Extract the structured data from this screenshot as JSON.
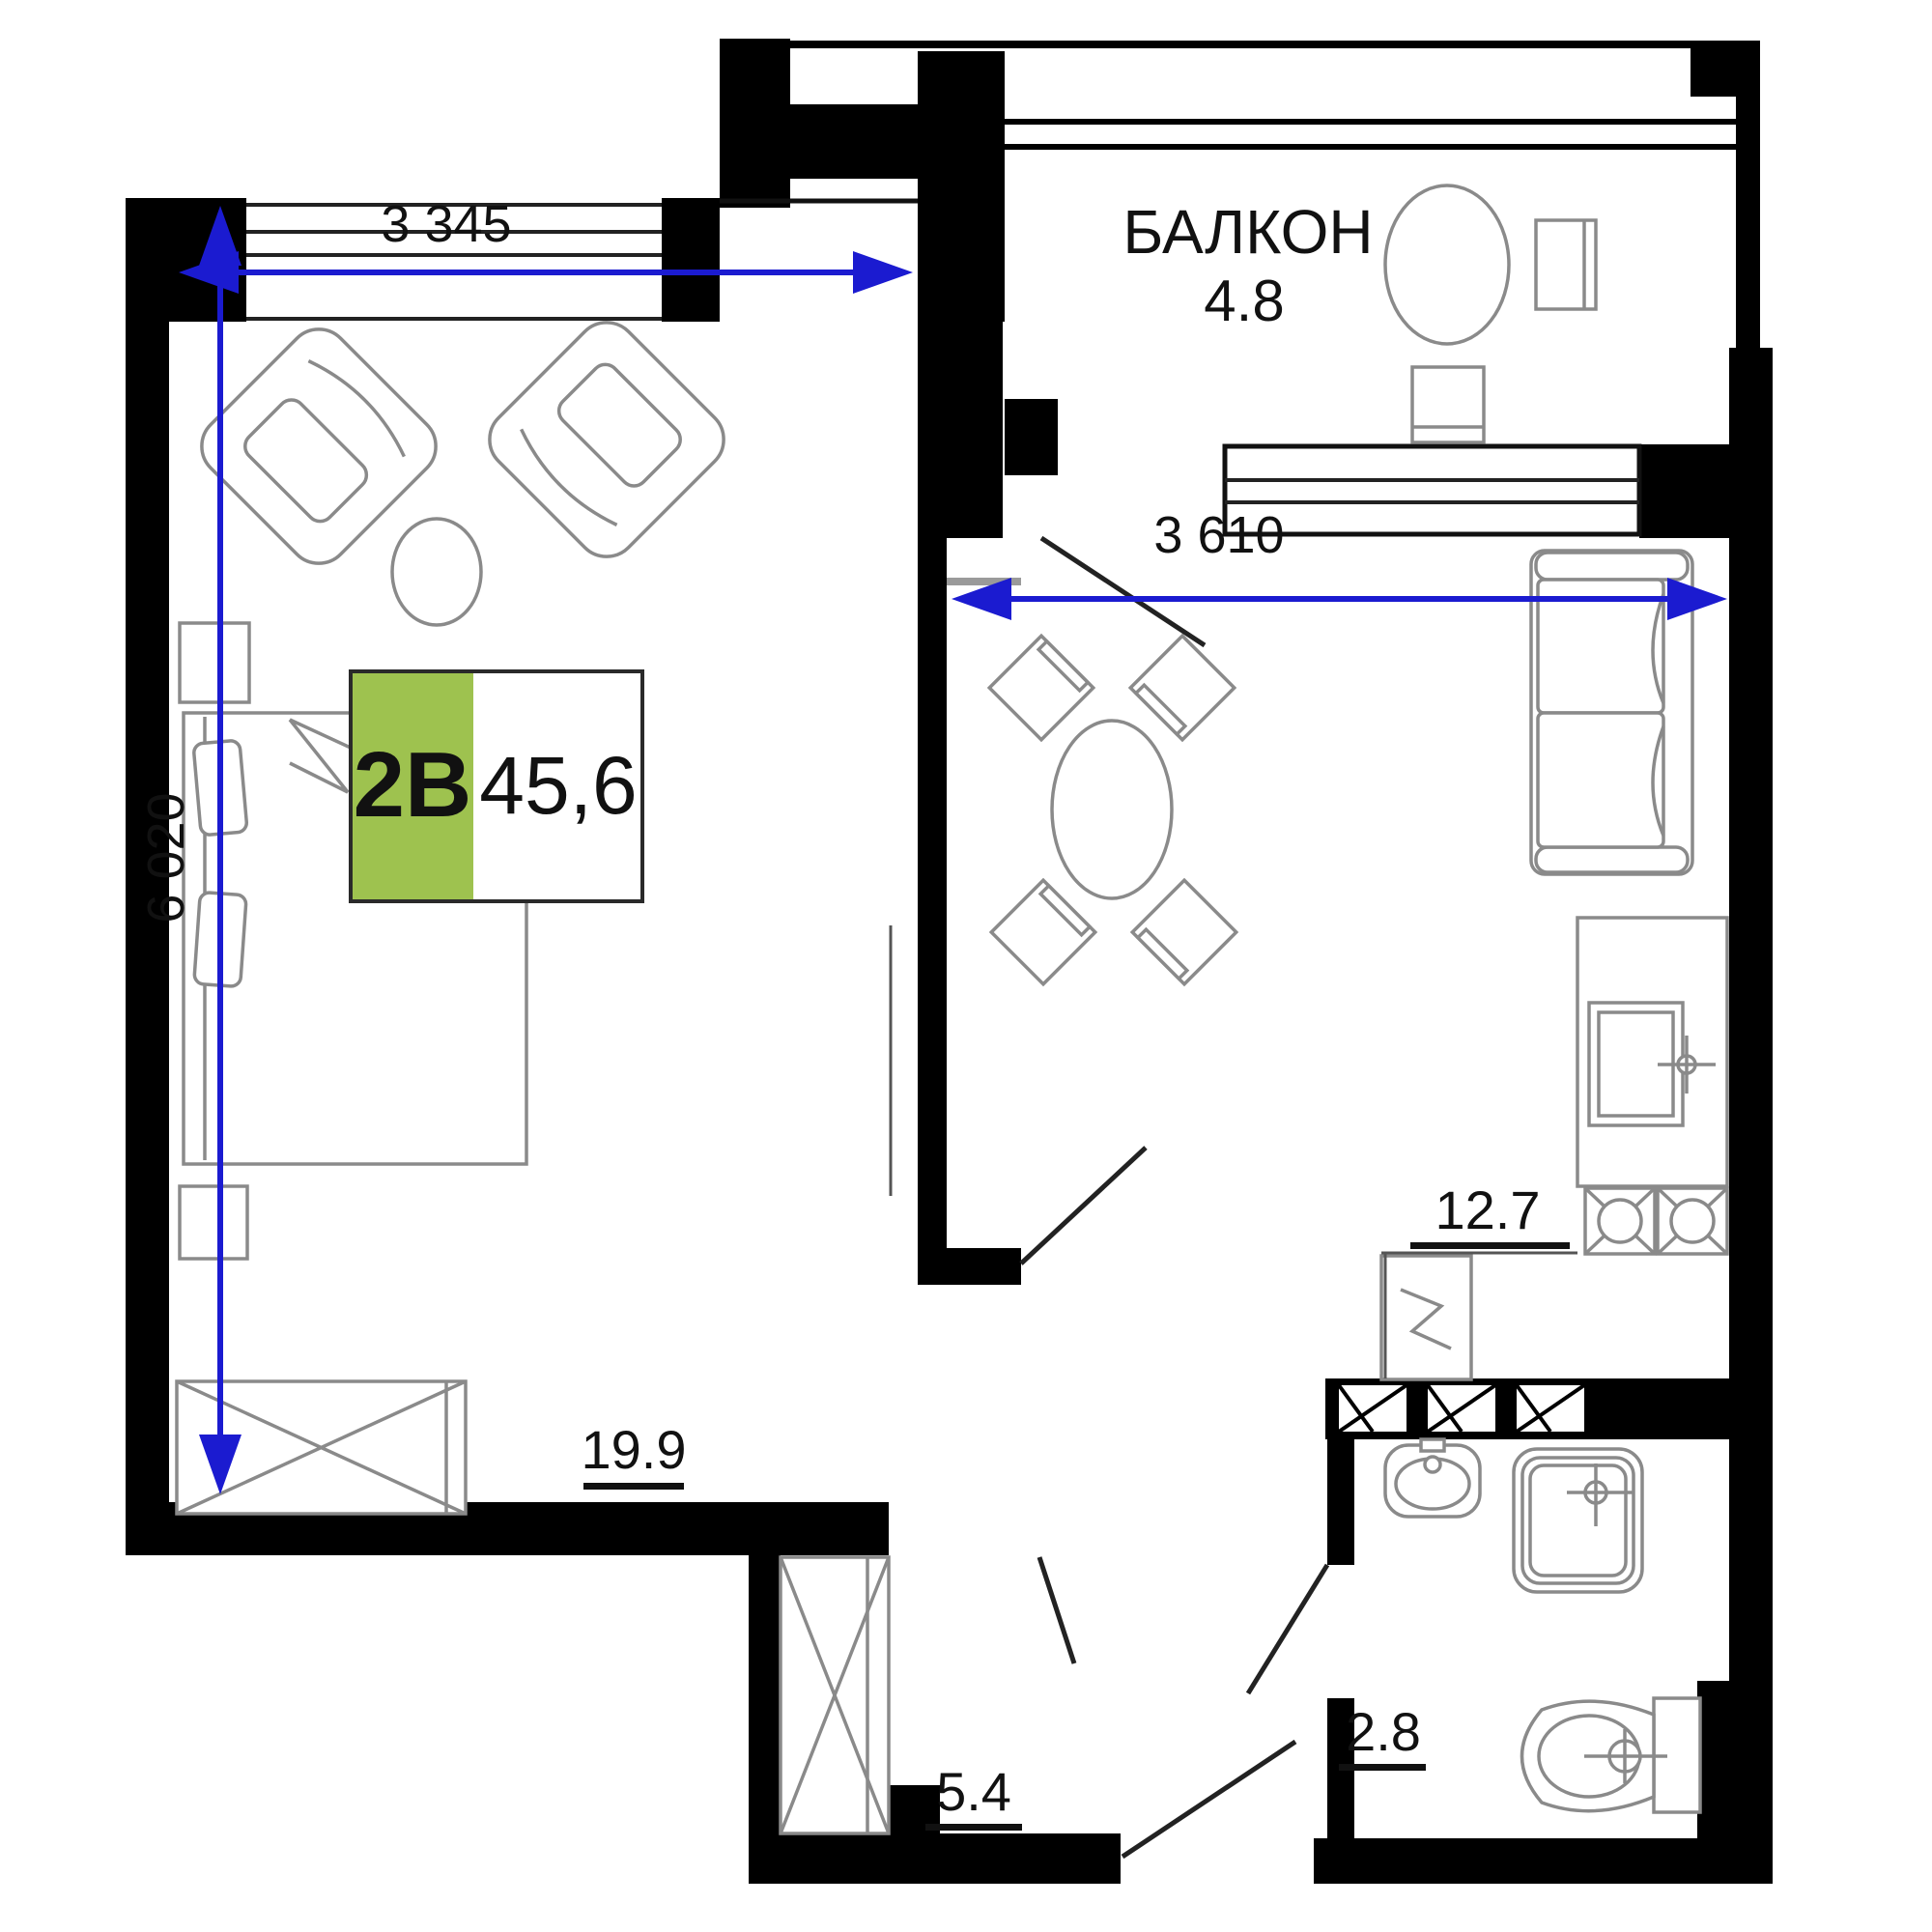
{
  "title": "Apartment floor plan",
  "colors": {
    "accent_green": "#9ec24f",
    "dimension_blue": "#1b1bd0",
    "wall_black": "#000000",
    "furniture_gray": "#8a8a8a"
  },
  "unit_card": {
    "type": "2B",
    "area": "45,6"
  },
  "rooms": {
    "balcony": {
      "name": "БАЛКОН",
      "area": "4.8"
    },
    "living": {
      "area": "19.9"
    },
    "kitchen": {
      "area": "12.7"
    },
    "hall": {
      "area": "5.4"
    },
    "bathroom": {
      "area": "2.8"
    }
  },
  "dimensions": {
    "living_width": "3 345",
    "kitchen_width": "3 610",
    "living_height": "6 020"
  }
}
